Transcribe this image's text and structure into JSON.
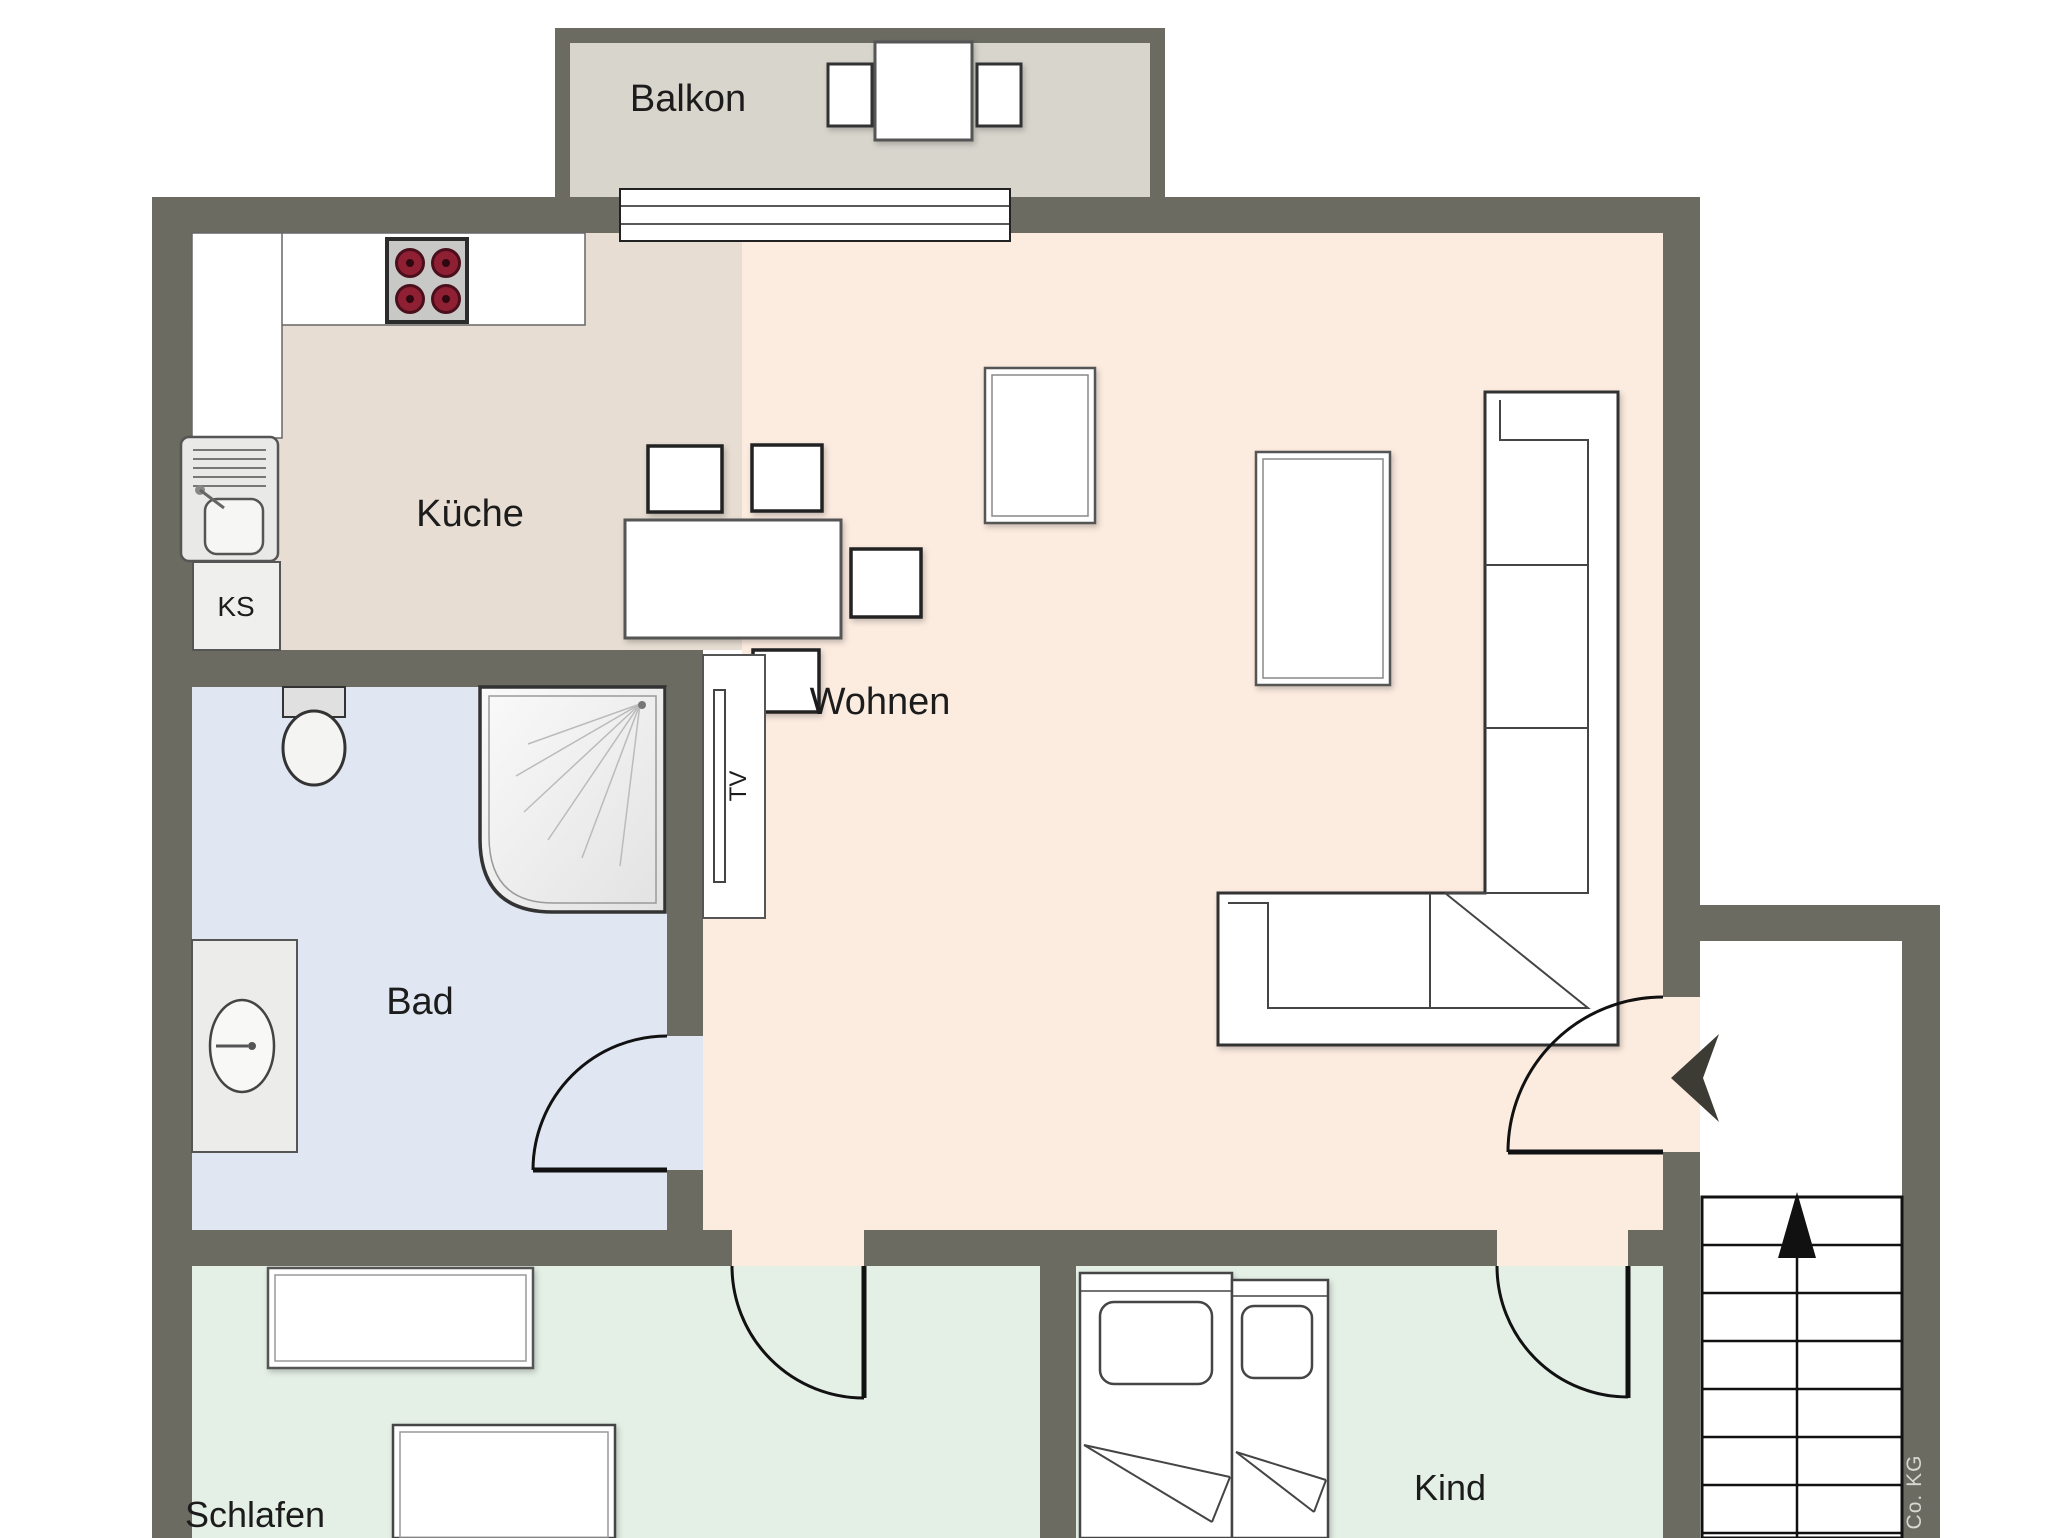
{
  "plan": {
    "rooms": {
      "balkon": {
        "label": "Balkon"
      },
      "kueche": {
        "label": "Küche"
      },
      "wohnen": {
        "label": "Wohnen"
      },
      "bad": {
        "label": "Bad"
      },
      "schlafen": {
        "label": "Schlafen"
      },
      "kind": {
        "label": "Kind"
      }
    },
    "labels": {
      "fridge": "KS",
      "tv": "TV"
    },
    "watermark": {
      "text": "Co. KG"
    },
    "colors": {
      "wall": "#6b6b62",
      "balcony_floor": "#d8d5cc",
      "kitchen_floor": "#e7ddd2",
      "living_floor": "#fcebdf",
      "bath_floor": "#e0e7f3",
      "bedroom_floor": "#e4f0e6",
      "child_floor": "#e4f0e6",
      "stairwell_floor": "#ffffff",
      "furniture_fill": "#ffffff",
      "outline": "#3a3a3a",
      "door_line": "#111111",
      "burner": "#8f2033",
      "label_text": "#1c1c1c",
      "watermark_text": "#d8d8d2"
    }
  }
}
